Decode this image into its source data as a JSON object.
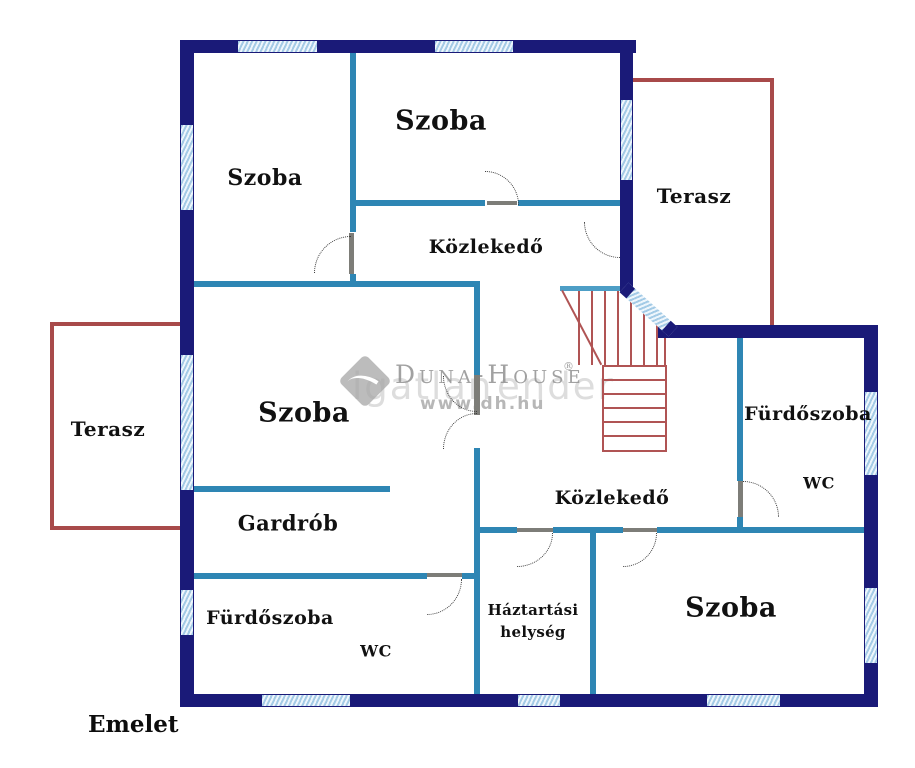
{
  "title": "Emelet",
  "rooms": {
    "szoba_top_left": {
      "label": "Szoba"
    },
    "szoba_top": {
      "label": "Szoba"
    },
    "szoba_main": {
      "label": "Szoba"
    },
    "szoba_bottom": {
      "label": "Szoba"
    },
    "terasz_left": {
      "label": "Terasz"
    },
    "terasz_right": {
      "label": "Terasz"
    },
    "kozlekedo_top": {
      "label": "Közlekedő"
    },
    "kozlekedo_main": {
      "label": "Közlekedő"
    },
    "furdoszoba_right": {
      "label": "Fürdőszoba"
    },
    "wc_right": {
      "label": "WC"
    },
    "gardrob": {
      "label": "Gardrób"
    },
    "furdoszoba_bottom_left": {
      "label": "Fürdőszoba"
    },
    "wc_bottom_left": {
      "label": "WC"
    },
    "haztartasi_helyseg": {
      "label_line1": "Háztartási",
      "label_line2": "helység"
    }
  },
  "watermark": {
    "brand": "Duna-House",
    "registered_mark": "®",
    "url": "www.dh.hu",
    "ghost_text_left": "igatlan",
    "ghost_text_right": "ender",
    "logo_icon": "duna-house-diamond-logo"
  },
  "colors": {
    "outer_wall": "#1a1a78",
    "inner_wall": "#2e86b4",
    "stairs_rail": "#4d9ec6",
    "window_fill": "#a4cbe6",
    "terrace_outline": "#a84a4a",
    "stairs_outline": "#b05454",
    "label_text": "#111111"
  }
}
